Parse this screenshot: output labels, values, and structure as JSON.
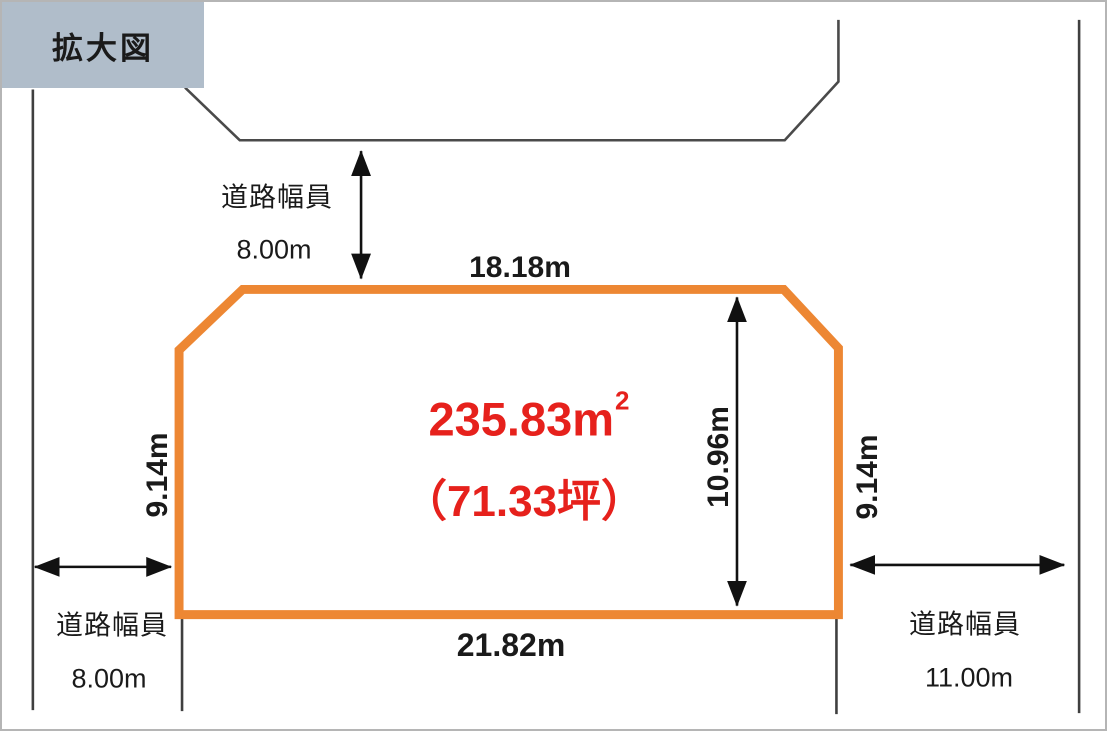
{
  "title": "拡大図",
  "parcel": {
    "area_m2": "235.83m",
    "area_exponent": "2",
    "area_tsubo": "（71.33坪）",
    "top_edge": "18.18m",
    "bottom_edge": "21.82m",
    "left_edge": "9.14m",
    "right_edge": "9.14m",
    "inner_depth": "10.96m"
  },
  "roads": {
    "top": {
      "label": "道路幅員",
      "width": "8.00m"
    },
    "left": {
      "label": "道路幅員",
      "width": "8.00m"
    },
    "right": {
      "label": "道路幅員",
      "width": "11.00m"
    }
  },
  "colors": {
    "parcel_outline": "#ED8733",
    "area_text": "#E6211C",
    "title_bg": "#B0BDCA",
    "boundary_line": "#3F3F3F",
    "dimension_text": "#1A1A1A"
  }
}
